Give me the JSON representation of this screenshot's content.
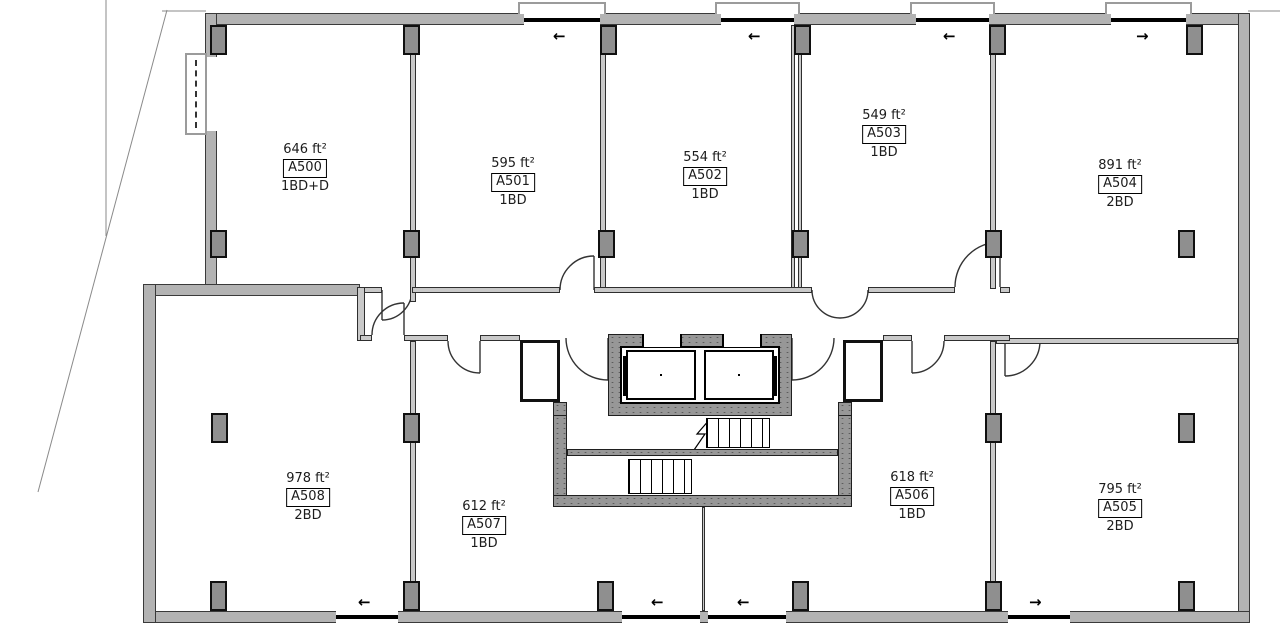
{
  "title": "Residential floor plan - level A5",
  "units": [
    {
      "id": "A500",
      "area": "646 ft²",
      "bedrooms": "1BD+D"
    },
    {
      "id": "A501",
      "area": "595 ft²",
      "bedrooms": "1BD"
    },
    {
      "id": "A502",
      "area": "554 ft²",
      "bedrooms": "1BD"
    },
    {
      "id": "A503",
      "area": "549 ft²",
      "bedrooms": "1BD"
    },
    {
      "id": "A504",
      "area": "891 ft²",
      "bedrooms": "2BD"
    },
    {
      "id": "A505",
      "area": "795 ft²",
      "bedrooms": "2BD"
    },
    {
      "id": "A506",
      "area": "618 ft²",
      "bedrooms": "1BD"
    },
    {
      "id": "A507",
      "area": "612 ft²",
      "bedrooms": "1BD"
    },
    {
      "id": "A508",
      "area": "978 ft²",
      "bedrooms": "2BD"
    }
  ],
  "icons": {
    "slide_left": "←",
    "slide_right": "→"
  },
  "colors": {
    "background": "#ffffff",
    "wall_fill": "#b3b3b3",
    "wall_edge": "#3a3a3a",
    "core_fill": "#979797",
    "column_fill": "#8f8f8f",
    "line": "#333333",
    "property_line": "#8a8a8a"
  }
}
